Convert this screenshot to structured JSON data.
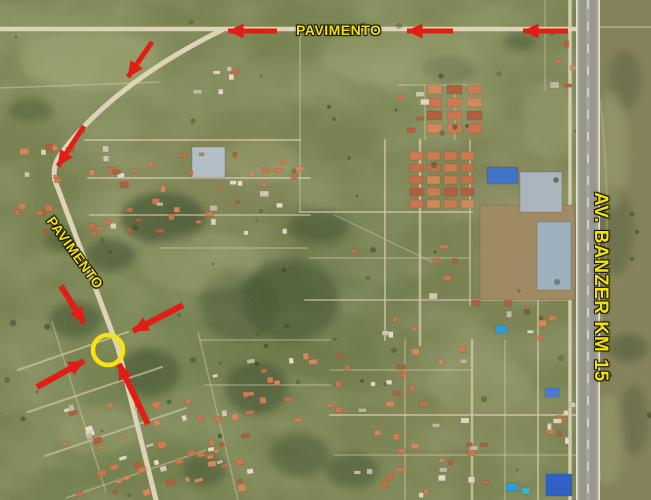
{
  "map": {
    "labels": {
      "top_road": "PAVIMENTO",
      "diagonal_road": "PAVIMENTO",
      "highway": "AV. BANZER KM 15"
    },
    "annotation_colors": {
      "arrow_red": "#e21d15",
      "label_yellow": "#f2e20a",
      "circle_yellow": "#f8e30c"
    },
    "annotations": {
      "target_marker": "yellow-circle-highlight",
      "arrow_count": 9
    }
  }
}
